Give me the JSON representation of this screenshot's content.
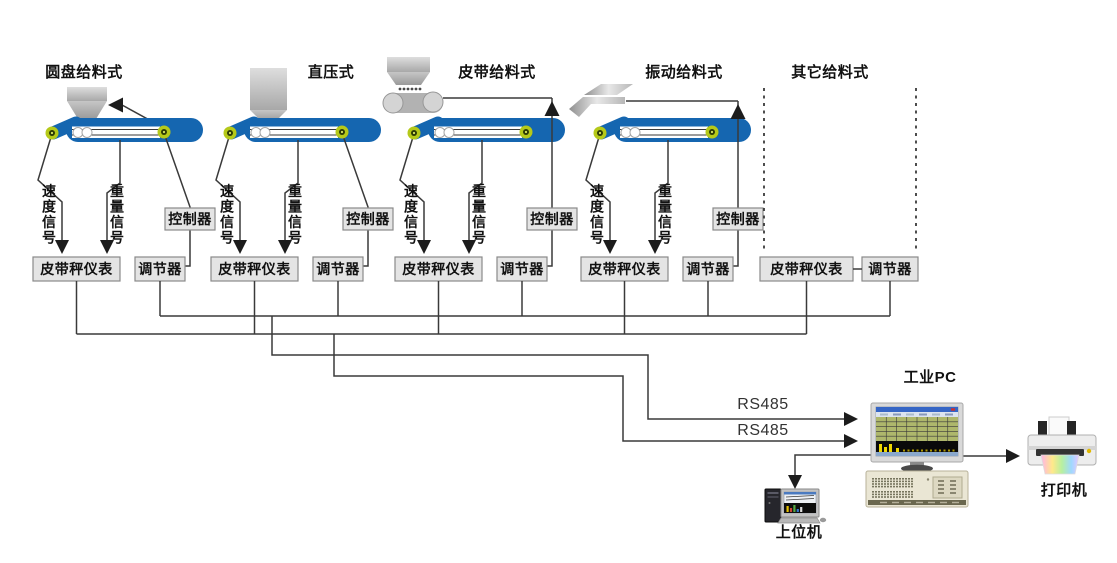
{
  "units": [
    {
      "id": "disc",
      "title": "圆盘给料式",
      "speed_signal": "速度信号",
      "weight_signal": "重量信号",
      "controller_label": "控制器",
      "instrument_label": "皮带秤仪表",
      "regulator_label": "调节器"
    },
    {
      "id": "press",
      "title": "直压式",
      "speed_signal": "速度信号",
      "weight_signal": "重量信号",
      "controller_label": "控制器",
      "instrument_label": "皮带秤仪表",
      "regulator_label": "调节器"
    },
    {
      "id": "belt-feeder",
      "title": "皮带给料式",
      "speed_signal": "速度信号",
      "weight_signal": "重量信号",
      "controller_label": "控制器",
      "instrument_label": "皮带秤仪表",
      "regulator_label": "调节器"
    },
    {
      "id": "vibratory",
      "title": "振动给料式",
      "speed_signal": "速度信号",
      "weight_signal": "重量信号",
      "controller_label": "控制器",
      "instrument_label": "皮带秤仪表",
      "regulator_label": "调节器"
    },
    {
      "id": "other",
      "title": "其它给料式",
      "instrument_label": "皮带秤仪表",
      "regulator_label": "调节器"
    }
  ],
  "bus_labels": {
    "rs485_top": "RS485",
    "rs485_bottom": "RS485"
  },
  "devices": {
    "industrial_pc_label": "工业PC",
    "host_computer_label": "上位机",
    "printer_label": "打印机"
  },
  "colors": {
    "line": "#3a3a3a",
    "belt_blue": "#1566b0",
    "roller_yellow": "#b5c919",
    "roller_core": "#2c3a04",
    "box_fill": "#e4e4e4",
    "box_border": "#8a8a8a"
  }
}
